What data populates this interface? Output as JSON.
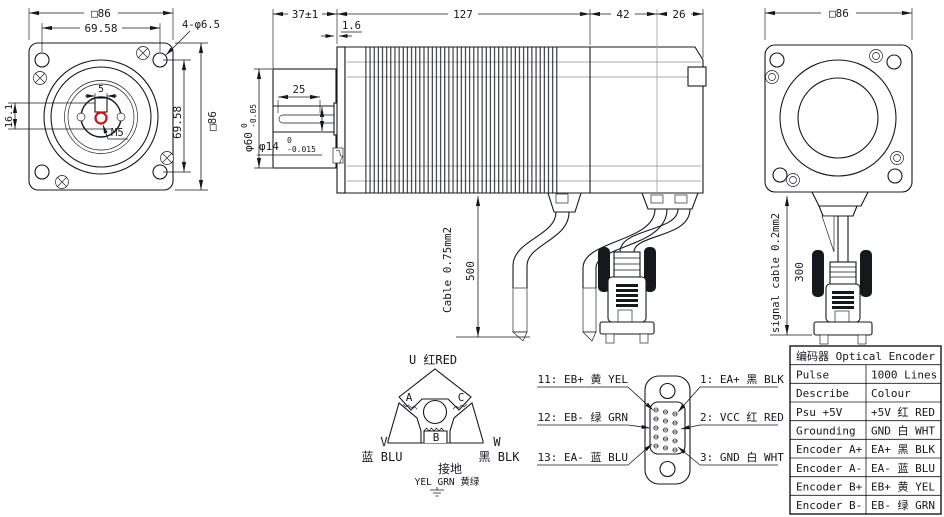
{
  "front_view": {
    "size_top": "□86",
    "bolt_circle": "69.58",
    "corner_holes": "4-φ6.5",
    "key_width": "5",
    "key_height": "16.1",
    "shaft_tap": "M5",
    "bolt_circle_side": "69.58",
    "size_side": "□86"
  },
  "side_view": {
    "shaft_length": "37±1",
    "pilot_depth": "1.6",
    "body_length": "127",
    "encoder_length": "42",
    "cap_length": "26",
    "key_length": "25",
    "pilot_dia": "φ60",
    "pilot_tol_upper": "0",
    "pilot_tol_lower": "-0.05",
    "shaft_dia": "φ14",
    "shaft_tol_upper": "0",
    "shaft_tol_lower": "-0.015",
    "power_cable_label": "Cable 0.75mm2",
    "power_cable_length": "500"
  },
  "rear_view": {
    "size_top": "□86",
    "signal_cable_label": "signal cable 0.2mm2",
    "signal_cable_length": "300"
  },
  "winding_diagram": {
    "phase_u": "U 红RED",
    "phase_v": "V",
    "phase_v_color": "蓝 BLU",
    "phase_w": "W",
    "phase_w_color": "黑 BLK",
    "coil_a": "A",
    "coil_b": "B",
    "coil_c": "C",
    "ground_label": "接地",
    "ground_color": "YEL GRN 黄绿"
  },
  "connector_pinout": {
    "left": [
      "11: EB+ 黄 YEL",
      "12: EB- 绿 GRN",
      "13: EA- 蓝 BLU"
    ],
    "right": [
      "1: EA+ 黑 BLK",
      "2: VCC 红 RED",
      "3: GND 白 WHT"
    ]
  },
  "encoder_table": {
    "title": "编码器 Optical Encoder",
    "rows": [
      [
        "Pulse",
        "1000 Lines"
      ],
      [
        "Describe",
        "Colour"
      ],
      [
        "Psu +5V",
        "+5V 红 RED"
      ],
      [
        "Grounding",
        "GND 白 WHT"
      ],
      [
        "Encoder A+",
        "EA+ 黑 BLK"
      ],
      [
        "Encoder A-",
        "EA- 蓝 BLU"
      ],
      [
        "Encoder B+",
        "EB+ 黄 YEL"
      ],
      [
        "Encoder B-",
        "EB- 绿 GRN"
      ]
    ]
  },
  "colors": {
    "line": "#15181c",
    "accent_red": "#cc1111",
    "construction_gray": "#a8a8a8"
  }
}
